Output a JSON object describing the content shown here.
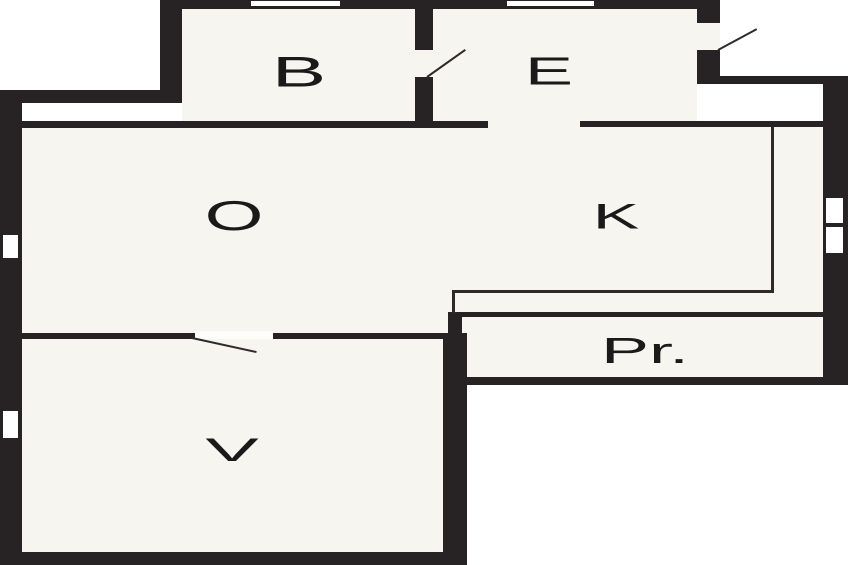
{
  "title": "apartment-floor-plan",
  "rooms": [
    {
      "id": "room-b",
      "label": "B"
    },
    {
      "id": "room-e",
      "label": "E"
    },
    {
      "id": "room-o",
      "label": "O"
    },
    {
      "id": "room-k",
      "label": "K"
    },
    {
      "id": "room-v",
      "label": "V"
    },
    {
      "id": "room-pr",
      "label": "Pr."
    }
  ],
  "features": {
    "doors": [
      "door-b-e",
      "door-entry-e",
      "door-o-v"
    ],
    "windows": [
      "window-top-b",
      "window-top-e",
      "window-left-upper",
      "window-left-lower",
      "window-right"
    ]
  },
  "colors": {
    "wall": "#272223",
    "floor": "#f6f5ef",
    "outside": "#ffffff",
    "line": "#2e292a",
    "label": "#1b191a"
  }
}
